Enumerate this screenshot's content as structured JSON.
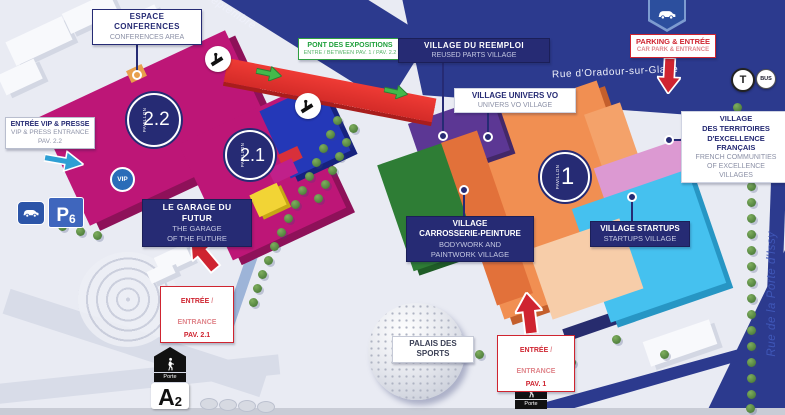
{
  "streets": {
    "septembre": "Septembre",
    "oradour": "Rue d'Oradour-sur-Glane",
    "porte_issy": "Rue de la Porte d'Issy"
  },
  "pavilions": [
    {
      "word": "PAVILLON",
      "num": "2.2"
    },
    {
      "word": "PAVILLON",
      "num": "2.1"
    },
    {
      "word": "PAVILLON",
      "num": "1"
    }
  ],
  "callouts": {
    "espace_conferences": {
      "fr": "ESPACE\nCONFERENCES",
      "en": "CONFERENCES AREA"
    },
    "pont_expositions": {
      "fr": "PONT DES EXPOSITIONS",
      "en": "ENTRE / BETWEEN PAV. 1 / PAV. 2.2"
    },
    "village_reemploi": {
      "fr": "VILLAGE DU REEMPLOI",
      "en": "REUSED PARTS VILLAGE"
    },
    "parking_entree": {
      "fr": "PARKING & ENTRÉE",
      "en": "CAR PARK & ENTRANCE"
    },
    "village_univers_vo": {
      "fr": "VILLAGE UNIVERS VO",
      "en": "UNIVERS VO VILLAGE"
    },
    "village_territoires": {
      "fr": "VILLAGE\nDES TERRITOIRES\nD'EXCELLENCE\nFRANÇAIS",
      "en": "FRENCH COMMUNITIES\nOF EXCELLENCE\nVILLAGES"
    },
    "entree_vip": {
      "fr": "ENTRÉE VIP & PRESSE",
      "en": "VIP & PRESS ENTRANCE",
      "pav": "PAV. 2.2"
    },
    "garage_futur": {
      "fr": "LE GARAGE DU FUTUR",
      "en": "THE GARAGE\nOF THE FUTURE"
    },
    "entree_21": {
      "fr": "ENTRÉE",
      "sep": " / ",
      "en": "ENTRANCE",
      "pav": "PAV. 2.1"
    },
    "village_carrosserie": {
      "fr": "VILLAGE\nCARROSSERIE-PEINTURE",
      "en": "BODYWORK AND\nPAINTWORK VILLAGE"
    },
    "village_startups": {
      "fr": "VILLAGE STARTUPS",
      "en": "STARTUPS VILLAGE"
    },
    "palais_sports": {
      "label": "PALAIS DES\nSPORTS"
    },
    "entree_1": {
      "fr": "ENTRÉE",
      "sep": " / ",
      "en": "ENTRANCE",
      "pav": "PAV. 1"
    }
  },
  "badges": {
    "vip": "VIP",
    "p": "P",
    "p_num": "6",
    "tram": "T",
    "bus": "BUS",
    "porte_a": "Porte",
    "porte_b": "Porte",
    "gate_letter": "A",
    "gate_number": "2"
  },
  "colors": {
    "street_blue": "#2c3a8e",
    "pavilion_magenta": "#bd1677",
    "bridge_red": "#e03030",
    "reemploi_purple": "#5c3794",
    "carrosserie_green": "#2e7d35",
    "pavilion1_orange": "#f18f52",
    "startups_cyan": "#45c1ef",
    "startups_pink": "#dc99d2",
    "salmon": "#f7cda9",
    "label_navy": "#262b74",
    "label_red": "#cf2430",
    "label_green": "#1fa03c",
    "vip_blue": "#2a6cb8"
  }
}
